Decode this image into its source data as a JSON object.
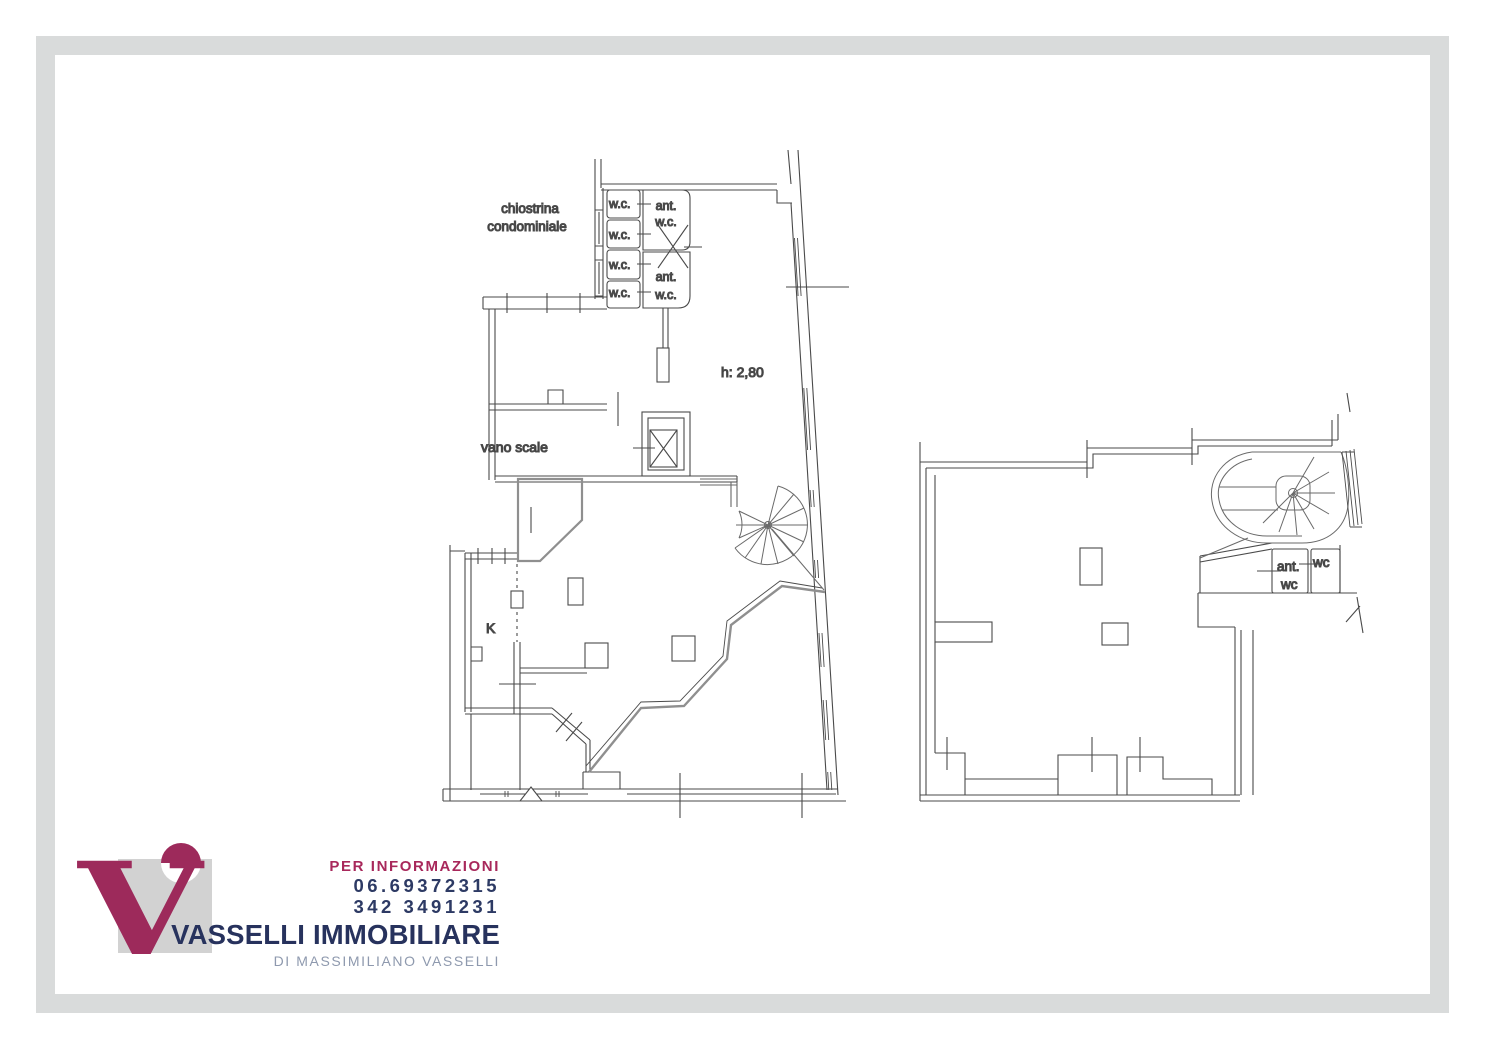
{
  "plan_left": {
    "labels": {
      "chiostrina_1": "chiostrina",
      "chiostrina_2": "condominiale",
      "wc_a": "w.c.",
      "wc_b": "w.c.",
      "wc_c": "w.c.",
      "wc_d": "w.c.",
      "ant_top_1": "ant.",
      "ant_top_2": "w.c.",
      "ant_bottom_1": "ant.",
      "ant_bottom_2": "w.c.",
      "height_note": "h: 2,80",
      "stairwell": "vano scale",
      "kitchen": "K"
    }
  },
  "plan_right": {
    "labels": {
      "ant_1": "ant.",
      "ant_2": "wc",
      "wc": "wc"
    }
  },
  "footer": {
    "info_heading": "PER INFORMAZIONI",
    "phone_1": "06.69372315",
    "phone_2": "342 3491231",
    "brand": "VASSELLI IMMOBILIARE",
    "tagline": "DI MASSIMILIANO VASSELLI",
    "monogram": "V"
  },
  "colors": {
    "maroon": "#9d2a5b",
    "navy": "#2d3a64",
    "tagline_gray": "#8e99ae",
    "frame_gray": "#d9dbdb",
    "logo_square_gray": "#d2d2d2",
    "plan_line": "#4a4a4a",
    "plan_wall_gray": "#8f8f8f"
  }
}
